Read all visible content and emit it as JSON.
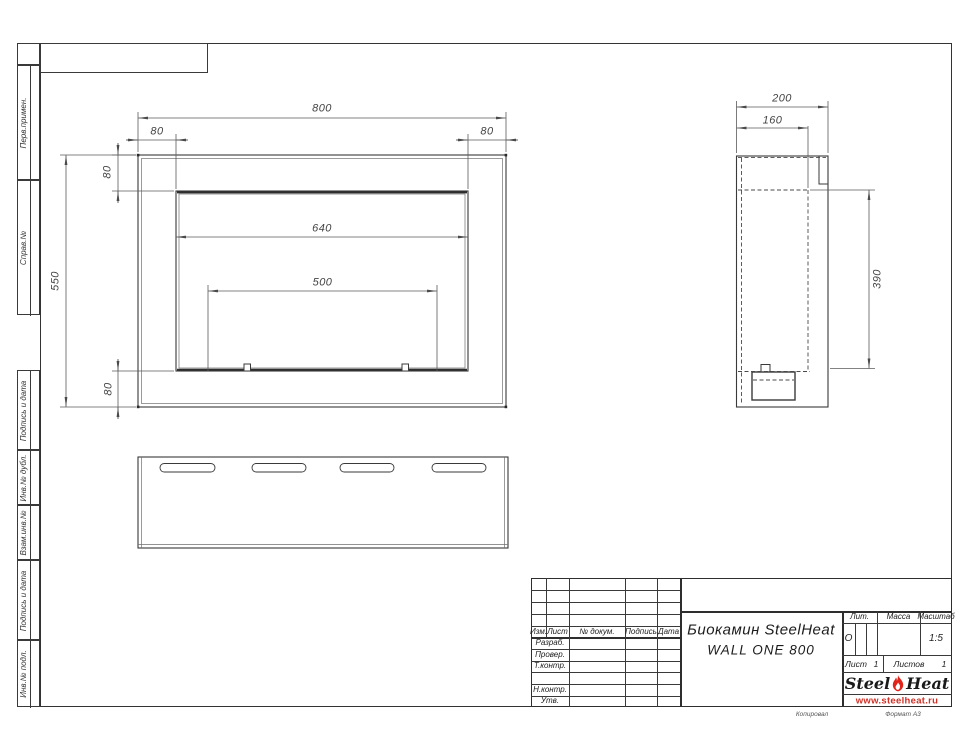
{
  "sheet": {
    "footer_left": "Копировал",
    "footer_right": "Формат А3"
  },
  "margin_labels": {
    "perv_primen": "Перв.примен.",
    "sprav_no": "Справ.№",
    "podpis_data_1": "Подпись и дата",
    "inv_dubl": "Инв.№ дубл.",
    "vzam_inv": "Взам.инв.№",
    "podpis_data_2": "Подпись и дата",
    "inv_podl": "Инв.№ подл."
  },
  "front_view": {
    "dim_width": "800",
    "dim_frame_left": "80",
    "dim_frame_right": "80",
    "dim_frame_top": "80",
    "dim_opening": "640",
    "dim_burner": "500",
    "dim_height": "550",
    "dim_frame_bottom": "80"
  },
  "side_view": {
    "dim_depth": "200",
    "dim_inner_depth": "160",
    "dim_height": "390"
  },
  "title_block": {
    "cols": {
      "izm": "Изм.",
      "list": "Лист",
      "doc": "№ докум.",
      "sign": "Подпись",
      "date": "Дата"
    },
    "rows": {
      "razrab": "Разраб.",
      "prover": "Провер.",
      "tkontr": "Т.контр.",
      "nkontr": "Н.контр.",
      "utv": "Утв."
    },
    "title_line1": "Биокамин SteelHeat",
    "title_line2": "WALL ONE 800",
    "lit_label": "Лит.",
    "massa_label": "Масса",
    "scale_label": "Масштаб",
    "lit_value": "О",
    "scale_value": "1:5",
    "sheet_label": "Лист",
    "sheet_value": "1",
    "sheets_label": "Листов",
    "sheets_value": "1",
    "logo": {
      "steel": "Steel",
      "heat": "Heat",
      "url": "www.steelheat.ru",
      "flame_color": "#e2231a",
      "url_color": "#d03026"
    }
  }
}
